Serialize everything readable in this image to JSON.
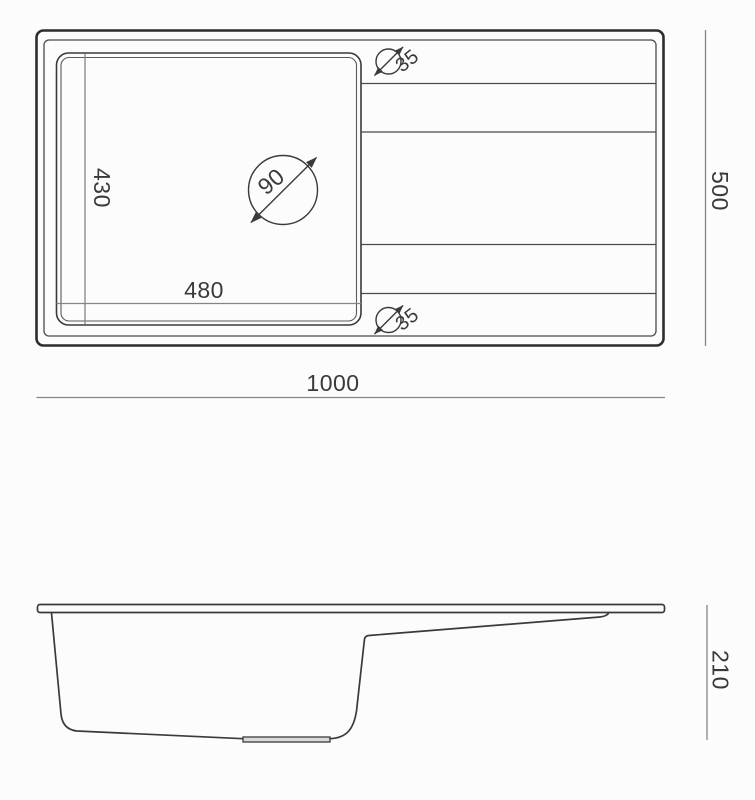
{
  "top_view": {
    "overall_width": "1000",
    "overall_depth": "500",
    "basin_width": "480",
    "basin_depth": "430",
    "drain_diameter": "90",
    "faucet_hole_top": "35",
    "faucet_hole_bottom": "35"
  },
  "side_view": {
    "height": "210"
  },
  "colors": {
    "background": "#fcfcfc",
    "outline": "#2d2d2d",
    "drawing_line": "#3a3a3a",
    "dimension_line": "#858585",
    "text": "#3a3a3a"
  }
}
